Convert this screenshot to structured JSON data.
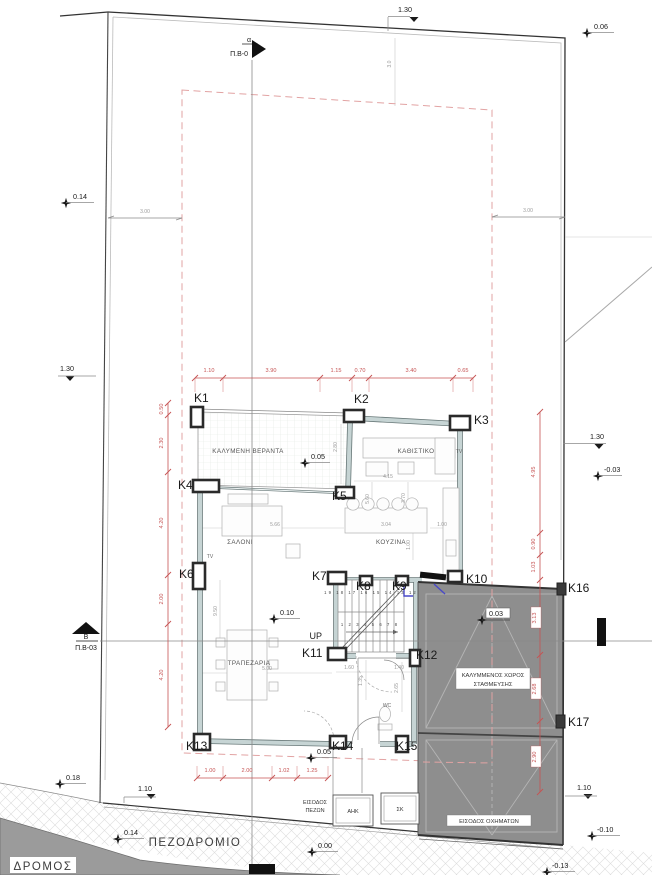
{
  "site": {
    "sidewalk_label": "ΠΕΖΟΔΡΟΜΙΟ",
    "road_label": "ΔΡΟΜΟΣ",
    "ped_entrance": [
      "ΕΙΣΟΔΟΣ",
      "ΠΕΖΩΝ"
    ],
    "vehicle_entrance": "ΕΙΣΟΔΟΣ ΟΧΗΜΑΤΩΝ",
    "utility_boxes": [
      "ΑΗΚ",
      "ΣΚ"
    ]
  },
  "sections": {
    "top": {
      "sub": "α",
      "label": "Π.Β-0"
    },
    "left": {
      "sub": "Β",
      "label": "Π.Β-03"
    }
  },
  "rooms": {
    "veranda": "ΚΑΛΥΜΕΝΗ ΒΕΡΑΝΤΑ",
    "sitting": "ΚΑΘΙΣΤΙΚΟ",
    "tv_sitting": "TV",
    "tv_living": "TV",
    "living": "ΣΑΛΟΝΙ",
    "kitchen": "ΚΟΥΖΙΝΑ",
    "dining": "ΤΡΑΠΕΖΑΡΙΑ",
    "wc": "WC",
    "stairs_up": "UP",
    "parking": [
      "ΚΑΛΥΜΜΕΝΟΣ ΧΩΡΟΣ",
      "ΣΤΑΘΜΕΥΣΗΣ"
    ]
  },
  "columns": [
    "K1",
    "K2",
    "K3",
    "K4",
    "K5",
    "K6",
    "K7",
    "K8",
    "K9",
    "K10",
    "K11",
    "K12",
    "K13",
    "K14",
    "K15",
    "K16",
    "K17"
  ],
  "levels": {
    "top_right": "0.06",
    "left_upper": "0.14",
    "bench_left": "1.30",
    "bench_top": "1.30",
    "bench_right": "1.30",
    "right_mid": "-0.03",
    "veranda": "0.05",
    "dining": "0.10",
    "parking": "0.03",
    "entrance": "0.05",
    "bottom_left": "0.18",
    "bench_bottom_left": "1.10",
    "sidewalk": "0.14",
    "zero": "0.00",
    "road_right": "-0.10",
    "road_low": "-0.13",
    "bench_bottom_right": "1.10"
  },
  "dims": {
    "top": [
      "1.10",
      "3.90",
      "1.15",
      "0.70",
      "3.40",
      "0.65"
    ],
    "left": [
      "0.50",
      "2.30",
      "4.20",
      "2.00",
      "4.20"
    ],
    "right": [
      "4.95",
      "0.90",
      "1.03",
      "3.13",
      "2.68",
      "2.90"
    ],
    "bottom": [
      "1.00",
      "2.00",
      "1.02",
      "1.25"
    ],
    "setback_left": "3.00",
    "setback_right": "3.00",
    "setback_top": "3.0",
    "interior": [
      "2.80",
      "4.15",
      "5.66",
      "3.04",
      "1.00",
      "5.60",
      "3.70",
      "1.00",
      "5.00",
      "9.50",
      "1.60",
      "1.40",
      "1.35",
      "2.65"
    ]
  },
  "stairs": {
    "upper_steps": "19 18 17 16 15 14 13 12",
    "lower_steps": "1 2 3 4 5 6 7 8"
  },
  "colors": {
    "dim_red": "#c65353",
    "setback_pink": "#e2a3a3",
    "parking_gray": "#8e8e8e",
    "road_gray": "#9b9b9b",
    "wall_fill": "#c6d4d4",
    "door_blue": "#4949c8"
  }
}
